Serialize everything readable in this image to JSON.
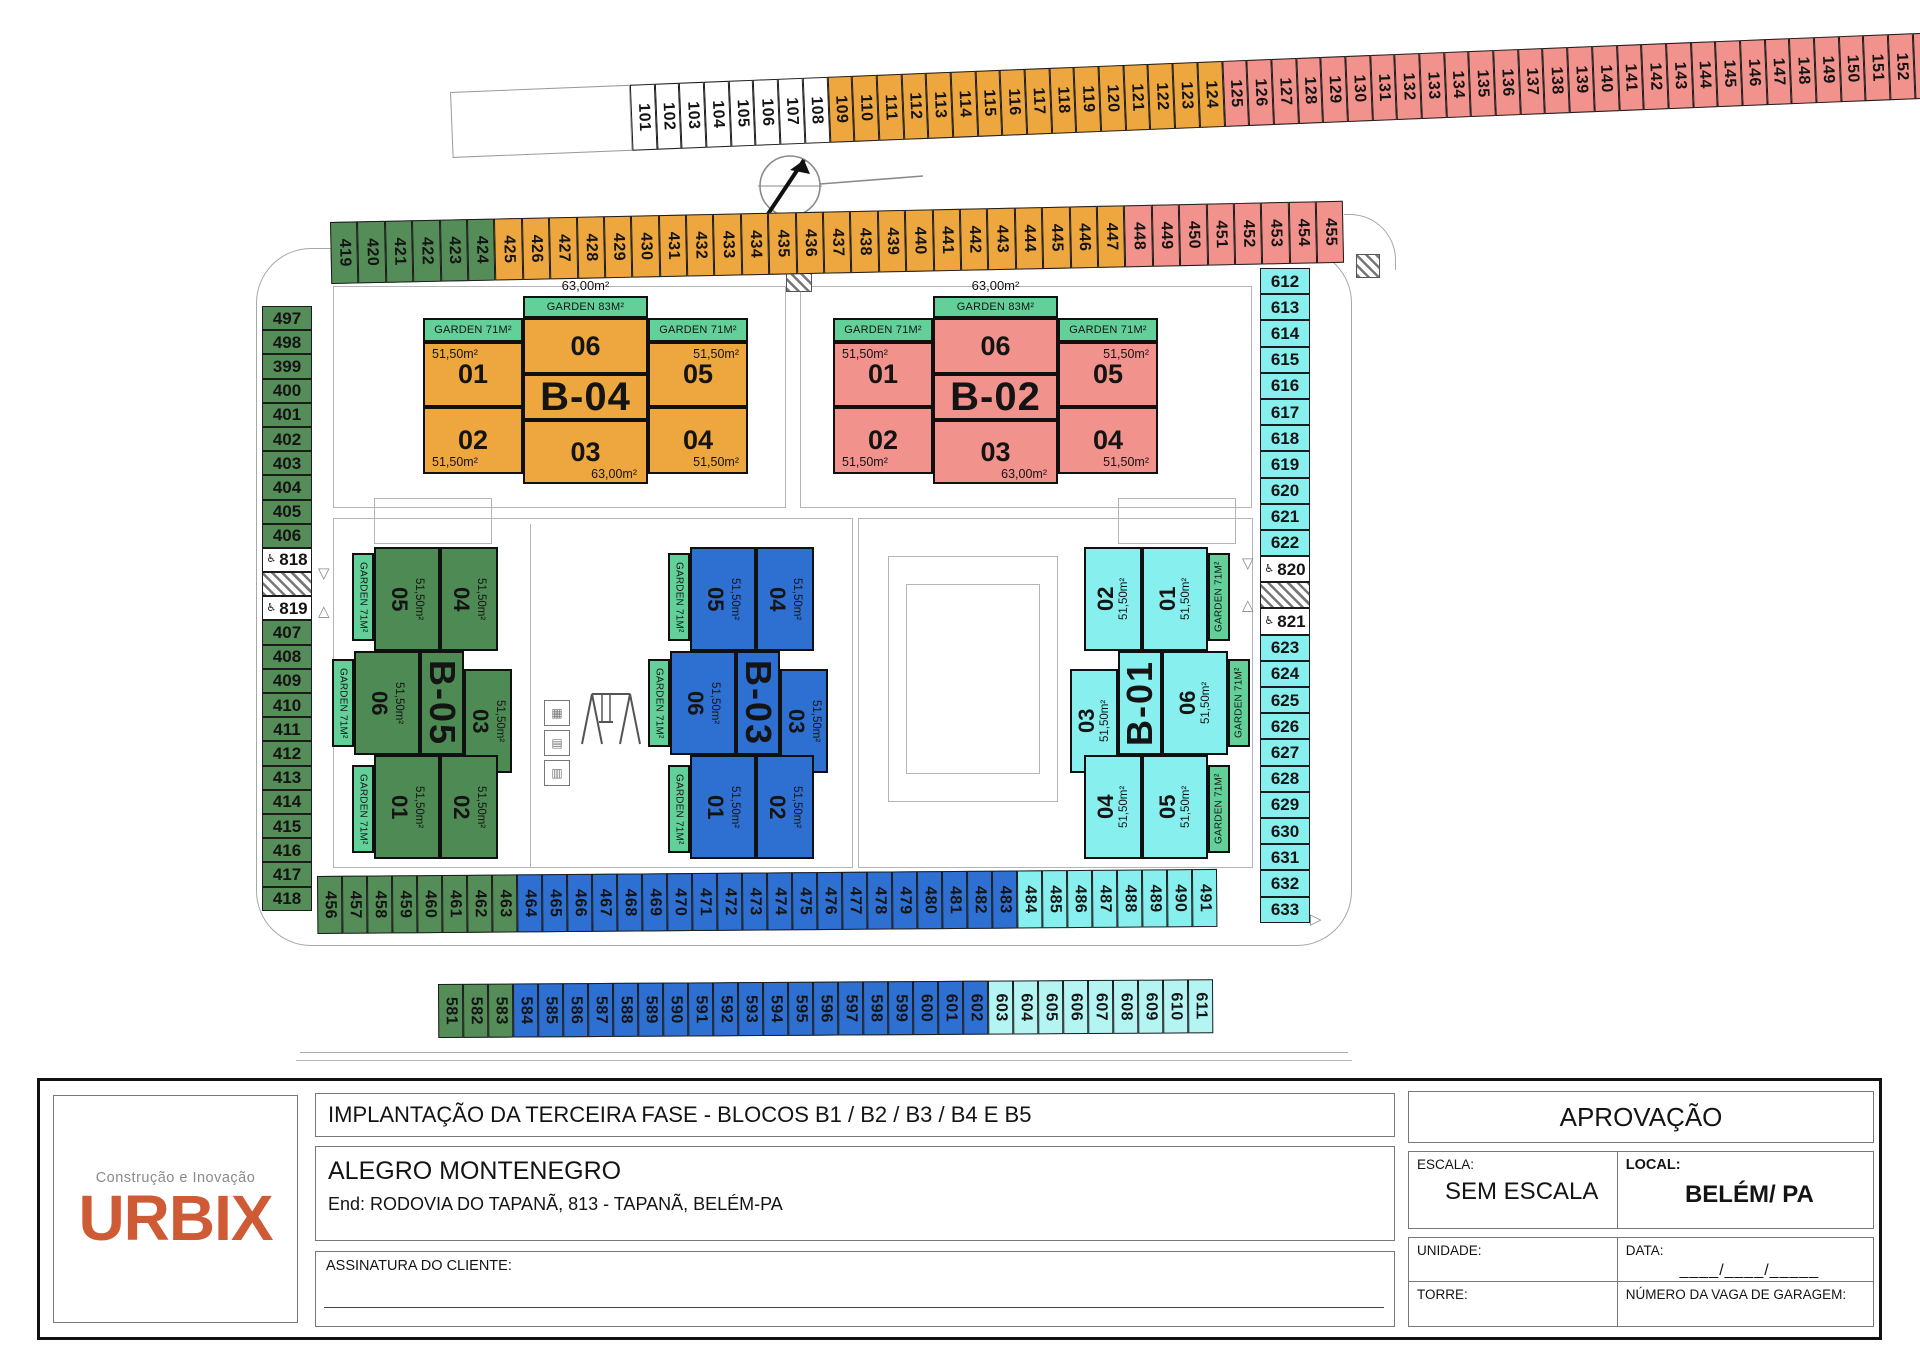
{
  "colors": {
    "white": "#FFFFFF",
    "orange": "#EDA73E",
    "pink": "#F2928C",
    "green": "#558D58",
    "blue": "#2E6FD2",
    "cyan": "#87F0EE",
    "cyan_light": "#B4F4F2",
    "garden": "#63D099",
    "b_orange": "#EDA73E",
    "b_pink": "#F2928C",
    "b_green": "#4E8A53",
    "b_blue": "#2E6FD2",
    "b_cyan": "#87F0EE"
  },
  "plan": {
    "rows": [
      {
        "name": "top",
        "lead": true,
        "groups": [
          {
            "color": "white",
            "from": 101,
            "to": 108
          },
          {
            "color": "orange",
            "from": 109,
            "to": 124
          },
          {
            "color": "pink",
            "from": 125,
            "to": 155
          }
        ]
      },
      {
        "name": "upper",
        "groups": [
          {
            "color": "green",
            "from": 419,
            "to": 424
          },
          {
            "color": "orange",
            "from": 425,
            "to": 447
          },
          {
            "color": "pink",
            "from": 448,
            "to": 455
          }
        ]
      },
      {
        "name": "b1",
        "groups": [
          {
            "color": "green",
            "from": 456,
            "to": 463
          },
          {
            "color": "blue",
            "from": 464,
            "to": 483
          },
          {
            "color": "cyan",
            "from": 484,
            "to": 491
          }
        ]
      },
      {
        "name": "b2",
        "groups": [
          {
            "color": "green",
            "from": 581,
            "to": 583
          },
          {
            "color": "blue",
            "from": 584,
            "to": 602
          },
          {
            "color": "cyan_light",
            "from": 603,
            "to": 611
          }
        ]
      }
    ],
    "columns": [
      {
        "name": "left",
        "cells": [
          {
            "n": "497",
            "c": "green"
          },
          {
            "n": "498",
            "c": "green"
          },
          {
            "n": "399",
            "c": "green"
          },
          {
            "n": "400",
            "c": "green"
          },
          {
            "n": "401",
            "c": "green"
          },
          {
            "n": "402",
            "c": "green"
          },
          {
            "n": "403",
            "c": "green"
          },
          {
            "n": "404",
            "c": "green"
          },
          {
            "n": "405",
            "c": "green"
          },
          {
            "n": "406",
            "c": "green"
          },
          {
            "n": "818",
            "c": "white",
            "icon": "♿"
          },
          {
            "hatch": true
          },
          {
            "n": "819",
            "c": "white",
            "icon": "♿"
          },
          {
            "n": "407",
            "c": "green"
          },
          {
            "n": "408",
            "c": "green"
          },
          {
            "n": "409",
            "c": "green"
          },
          {
            "n": "410",
            "c": "green"
          },
          {
            "n": "411",
            "c": "green"
          },
          {
            "n": "412",
            "c": "green"
          },
          {
            "n": "413",
            "c": "green"
          },
          {
            "n": "414",
            "c": "green"
          },
          {
            "n": "415",
            "c": "green"
          },
          {
            "n": "416",
            "c": "green"
          },
          {
            "n": "417",
            "c": "green"
          },
          {
            "n": "418",
            "c": "green"
          }
        ]
      },
      {
        "name": "right",
        "cells": [
          {
            "n": "612",
            "c": "cyan"
          },
          {
            "n": "613",
            "c": "cyan"
          },
          {
            "n": "614",
            "c": "cyan"
          },
          {
            "n": "615",
            "c": "cyan"
          },
          {
            "n": "616",
            "c": "cyan"
          },
          {
            "n": "617",
            "c": "cyan"
          },
          {
            "n": "618",
            "c": "cyan"
          },
          {
            "n": "619",
            "c": "cyan"
          },
          {
            "n": "620",
            "c": "cyan"
          },
          {
            "n": "621",
            "c": "cyan"
          },
          {
            "n": "622",
            "c": "cyan"
          },
          {
            "n": "820",
            "c": "white",
            "icon": "♿"
          },
          {
            "hatch": true
          },
          {
            "n": "821",
            "c": "white",
            "icon": "♿"
          },
          {
            "n": "623",
            "c": "cyan"
          },
          {
            "n": "624",
            "c": "cyan"
          },
          {
            "n": "625",
            "c": "cyan"
          },
          {
            "n": "626",
            "c": "cyan"
          },
          {
            "n": "627",
            "c": "cyan"
          },
          {
            "n": "628",
            "c": "cyan"
          },
          {
            "n": "629",
            "c": "cyan"
          },
          {
            "n": "630",
            "c": "cyan"
          },
          {
            "n": "631",
            "c": "cyan"
          },
          {
            "n": "632",
            "c": "cyan"
          },
          {
            "n": "633",
            "c": "cyan"
          }
        ]
      }
    ],
    "buildings": [
      {
        "label": "B-04",
        "type": "hb",
        "x": 423,
        "y": 296,
        "color": "b_orange",
        "top_area": "63,00m²",
        "gardens": [
          {
            "slot": "gtop",
            "label": "GARDEN 83M²"
          },
          {
            "slot": "gleft",
            "label": "GARDEN 71M²"
          },
          {
            "slot": "gright",
            "label": "GARDEN 71M²"
          }
        ],
        "units": [
          {
            "slot": "u01",
            "num": "01",
            "area": "51,50m²"
          },
          {
            "slot": "u06",
            "num": "06"
          },
          {
            "slot": "u05",
            "num": "05",
            "area": "51,50m²"
          },
          {
            "slot": "u02",
            "num": "02",
            "area": "51,50m²"
          },
          {
            "slot": "u03",
            "num": "03",
            "area": "63,00m²"
          },
          {
            "slot": "u04",
            "num": "04",
            "area": "51,50m²"
          }
        ]
      },
      {
        "label": "B-02",
        "type": "hb",
        "x": 833,
        "y": 296,
        "color": "b_pink",
        "top_area": "63,00m²",
        "gardens": [
          {
            "slot": "gtop",
            "label": "GARDEN 83M²"
          },
          {
            "slot": "gleft",
            "label": "GARDEN 71M²"
          },
          {
            "slot": "gright",
            "label": "GARDEN 71M²"
          }
        ],
        "units": [
          {
            "slot": "u01",
            "num": "01",
            "area": "51,50m²"
          },
          {
            "slot": "u06",
            "num": "06"
          },
          {
            "slot": "u05",
            "num": "05",
            "area": "51,50m²"
          },
          {
            "slot": "u02",
            "num": "02",
            "area": "51,50m²"
          },
          {
            "slot": "u03",
            "num": "03",
            "area": "63,00m²"
          },
          {
            "slot": "u04",
            "num": "04",
            "area": "51,50m²"
          }
        ]
      },
      {
        "label": "B-05",
        "type": "vb",
        "x": 332,
        "y": 547,
        "color": "b_green",
        "gardens": [
          {
            "slot": "g1",
            "label": "GARDEN 71M²"
          },
          {
            "slot": "g2",
            "label": "GARDEN 71M²"
          },
          {
            "slot": "g3",
            "label": "GARDEN 71M²"
          }
        ],
        "units": [
          {
            "slot": "u05",
            "num": "05",
            "area": "51,50m²"
          },
          {
            "slot": "u04",
            "num": "04",
            "area": "51,50m²"
          },
          {
            "slot": "u06",
            "num": "06",
            "area": "51,50m²"
          },
          {
            "slot": "u03",
            "num": "03",
            "area": "51,50m²"
          },
          {
            "slot": "u01",
            "num": "01",
            "area": "51,50m²"
          },
          {
            "slot": "u02",
            "num": "02",
            "area": "51,50m²"
          }
        ]
      },
      {
        "label": "B-03",
        "type": "vb",
        "x": 648,
        "y": 547,
        "color": "b_blue",
        "gardens": [
          {
            "slot": "g1",
            "label": "GARDEN 71M²"
          },
          {
            "slot": "g2",
            "label": "GARDEN 71M²"
          },
          {
            "slot": "g3",
            "label": "GARDEN 71M²"
          }
        ],
        "units": [
          {
            "slot": "u05",
            "num": "05",
            "area": "51,50m²"
          },
          {
            "slot": "u04",
            "num": "04",
            "area": "51,50m²"
          },
          {
            "slot": "u06",
            "num": "06",
            "area": "51,50m²"
          },
          {
            "slot": "u03",
            "num": "03",
            "area": "51,50m²"
          },
          {
            "slot": "u01",
            "num": "01",
            "area": "51,50m²"
          },
          {
            "slot": "u02",
            "num": "02",
            "area": "51,50m²"
          }
        ]
      },
      {
        "label": "B-01",
        "type": "vb-r",
        "x": 1070,
        "y": 547,
        "color": "b_cyan",
        "gardens": [
          {
            "slot": "g1",
            "label": "GARDEN 71M²"
          },
          {
            "slot": "g2",
            "label": "GARDEN 71M²"
          },
          {
            "slot": "g3",
            "label": "GARDEN 71M²"
          }
        ],
        "units": [
          {
            "slot": "u02",
            "num": "02",
            "area": "51,50m²"
          },
          {
            "slot": "u01",
            "num": "01",
            "area": "51,50m²"
          },
          {
            "slot": "u03",
            "num": "03",
            "area": "51,50m²"
          },
          {
            "slot": "u06",
            "num": "06",
            "area": "51,50m²"
          },
          {
            "slot": "u04",
            "num": "04",
            "area": "51,50m²"
          },
          {
            "slot": "u05",
            "num": "05",
            "area": "51,50m²"
          }
        ]
      }
    ],
    "markers": [
      {
        "x": 318,
        "y": 566,
        "dir": "down"
      },
      {
        "x": 318,
        "y": 604,
        "dir": "up"
      },
      {
        "x": 1242,
        "y": 556,
        "dir": "down"
      },
      {
        "x": 1242,
        "y": 598,
        "dir": "up"
      },
      {
        "x": 1310,
        "y": 912,
        "dir": "right"
      }
    ],
    "equipment_icons": [
      "▦",
      "▤",
      "▥"
    ]
  },
  "title_block": {
    "logo": {
      "tagline": "Construção e Inovação",
      "brand": "URBIX"
    },
    "drawing_title": "IMPLANTAÇÃO DA TERCEIRA FASE - BLOCOS B1 / B2 / B3 / B4 E B5",
    "project": "ALEGRO MONTENEGRO",
    "address": "End: RODOVIA DO TAPANÃ, 813 - TAPANÃ, BELÉM-PA",
    "signature_label": "ASSINATURA DO CLIENTE:",
    "approval": {
      "title": "APROVAÇÃO",
      "scale_label": "ESCALA:",
      "scale_value": "SEM ESCALA",
      "local_label": "LOCAL:",
      "local_value": "BELÉM/ PA",
      "unit_label": "UNIDADE:",
      "date_label": "DATA:",
      "date_blank": "____/____/_____",
      "tower_label": "TORRE:",
      "garage_label": "NÚMERO DA VAGA DE GARAGEM:"
    }
  }
}
